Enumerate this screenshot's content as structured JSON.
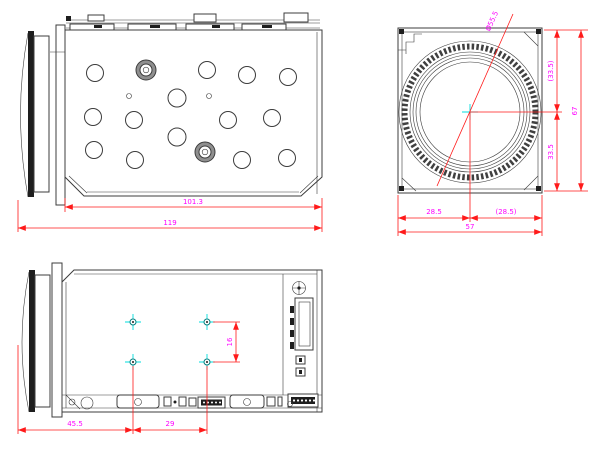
{
  "drawing": {
    "colors": {
      "outline": "#3c3c3c",
      "dimension_line": "#ff1a1a",
      "dimension_text": "#ff00ff",
      "crosshair_cyan": "#00dcdc",
      "hole_teal": "#007f7f"
    },
    "side_view": {
      "dims": {
        "body_length": "101.3",
        "overall_length": "119"
      }
    },
    "front_view": {
      "dims": {
        "lens_diameter": "Ø55.5",
        "half_height_ref": "(33.5)",
        "height": "67",
        "half_height": "33.5",
        "half_width": "28.5",
        "half_width_ref": "(28.5)",
        "width": "57"
      }
    },
    "bottom_view": {
      "dims": {
        "front_to_hole": "45.5",
        "hole_pitch_x": "29",
        "hole_pitch_y": "16"
      }
    }
  }
}
